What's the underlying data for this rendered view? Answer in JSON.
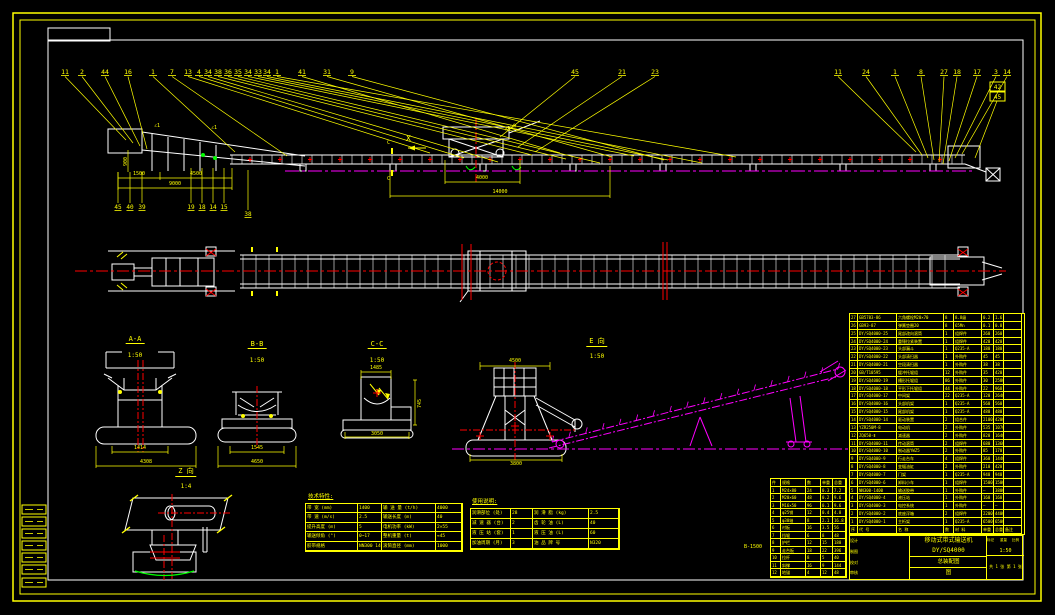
{
  "colors": {
    "accent": "#FFFF00",
    "line": "#FFFFFF",
    "centerline": "#FF0000",
    "phantom": "#FF00FF",
    "green": "#00FF00"
  },
  "views": {
    "sectionAA": {
      "label": "A-A",
      "scale": "1:50",
      "dim_inner": "1414",
      "dim_outer": "4308"
    },
    "sectionBB": {
      "label": "B-B",
      "scale": "1:50",
      "dim_inner": "1545",
      "dim_outer": "4650"
    },
    "sectionCC": {
      "label": "C-C",
      "scale": "1:50",
      "dim_top": "1485",
      "dim_right": "745",
      "dim_bottom": "3050"
    },
    "viewE": {
      "label": "E 向",
      "scale": "1:50",
      "dim_top": "4500",
      "dim_bottom": "3800"
    },
    "detailZ": {
      "label": "Z 向",
      "scale": "1:4"
    }
  },
  "side_view": {
    "view_marker": "X",
    "cut_mark": "C",
    "slope_mark": "∠1",
    "dims": {
      "v1": "900",
      "d1": "1500",
      "d2": "4500",
      "d3": "9000",
      "d4": "4000",
      "d5": "14000",
      "arm": "4000"
    }
  },
  "leaders": {
    "left": [
      "11",
      "2",
      "44",
      "16",
      "1",
      "7",
      "13",
      "4",
      "34",
      "38",
      "36",
      "35",
      "34",
      "33",
      "34",
      "1"
    ],
    "mid": [
      "41",
      "31",
      "9"
    ],
    "carr": [
      "45",
      "21",
      "23"
    ],
    "right": [
      "11",
      "24",
      "1",
      "8",
      "27",
      "18",
      "17",
      "3",
      "14"
    ],
    "stack": [
      "42",
      "45"
    ],
    "under": [
      "45",
      "40",
      "39",
      "19",
      "18",
      "14",
      "15",
      "38"
    ]
  },
  "tech_table": {
    "title": "技术特性:",
    "rows": [
      [
        "带 宽 (mm)",
        "1400",
        "输 送 量 (t/h)",
        "4000"
      ],
      [
        "带 速 (m/s)",
        "2.5",
        "输送长度 (m)",
        "40"
      ],
      [
        "提升高度 (m)",
        "5",
        "电机功率 (kW)",
        "2×55"
      ],
      [
        "输送倾角 (°)",
        "0~17",
        "整机重量 (t)",
        "≈45"
      ],
      [
        "胶带规格",
        "NN300 1400×6",
        "滚筒直径 (mm)",
        "1000"
      ]
    ]
  },
  "lub_table": {
    "title": "使用说明:",
    "rows": [
      [
        "润滑部位 (处)",
        "28",
        "润 滑 脂 (kg)",
        "2.5"
      ],
      [
        "减 速 器 (台)",
        "2",
        "齿 轮 油 (L)",
        "40"
      ],
      [
        "液 压 站 (套)",
        "1",
        "液 压 油 (L)",
        "60"
      ],
      [
        "加油周期 (月)",
        "3",
        "油 品 牌 号",
        "N320"
      ]
    ]
  },
  "left_table": {
    "note": "B-1500",
    "header": [
      "件",
      "规格",
      "数",
      "单重",
      "总重"
    ],
    "rows": [
      [
        "1",
        "M24×80",
        "24",
        "0.3",
        "7.2"
      ],
      [
        "2",
        "M20×60",
        "48",
        "0.2",
        "9.6"
      ],
      [
        "3",
        "M16×50",
        "96",
        "0.1",
        "9.6"
      ],
      [
        "4",
        "φ25销",
        "12",
        "0.4",
        "4.8"
      ],
      [
        "5",
        "φ30轴",
        "8",
        "2.1",
        "16.8"
      ],
      [
        "6",
        "衬板",
        "16",
        "3.5",
        "56"
      ],
      [
        "7",
        "挡辊",
        "6",
        "8",
        "48"
      ],
      [
        "8",
        "护栏",
        "12",
        "15",
        "180"
      ],
      [
        "9",
        "走台板",
        "18",
        "22",
        "396"
      ],
      [
        "10",
        "拉杆",
        "8",
        "5",
        "40"
      ],
      [
        "11",
        "斜撑",
        "16",
        "9",
        "144"
      ],
      [
        "12",
        "地锚",
        "4",
        "12",
        "48"
      ]
    ]
  },
  "bom": {
    "header": [
      "序",
      "代  号",
      "名  称",
      "数",
      "材 料",
      "单重",
      "总重",
      "备注"
    ],
    "rows": [
      [
        "27",
        "GB5783-86",
        "六角螺栓M20×70",
        "8",
        "8.8级",
        "0.2",
        "1.6",
        ""
      ],
      [
        "26",
        "GB93-87",
        "弹簧垫圈20",
        "8",
        "65Mn",
        "0.1",
        "0.8",
        ""
      ],
      [
        "25",
        "DY/SQ4000-25",
        "尾部改向滚筒",
        "1",
        "组焊件",
        "260",
        "260",
        ""
      ],
      [
        "24",
        "DY/SQ4000-24",
        "重锤拉紧装置",
        "1",
        "组焊件",
        "420",
        "420",
        ""
      ],
      [
        "23",
        "DY/SQ4000-23",
        "头部漏斗",
        "1",
        "Q235-A",
        "180",
        "180",
        ""
      ],
      [
        "22",
        "DY/SQ4000-22",
        "头部清扫器",
        "1",
        "外购件",
        "45",
        "45",
        ""
      ],
      [
        "21",
        "DY/SQ4000-21",
        "空段清扫器",
        "1",
        "外购件",
        "38",
        "38",
        ""
      ],
      [
        "20",
        "GB/T10595",
        "缓冲托辊组",
        "12",
        "外购件",
        "35",
        "420",
        ""
      ],
      [
        "19",
        "DY/SQ4000-19",
        "槽形托辊组",
        "86",
        "外购件",
        "30",
        "2580",
        ""
      ],
      [
        "18",
        "DY/SQ4000-18",
        "平形下托辊组",
        "44",
        "外购件",
        "22",
        "968",
        ""
      ],
      [
        "17",
        "DY/SQ4000-17",
        "中间架",
        "22",
        "Q235-A",
        "120",
        "2640",
        ""
      ],
      [
        "16",
        "DY/SQ4000-16",
        "头部机架",
        "1",
        "Q235-A",
        "560",
        "560",
        ""
      ],
      [
        "15",
        "DY/SQ4000-15",
        "尾部机架",
        "1",
        "Q235-A",
        "480",
        "480",
        ""
      ],
      [
        "14",
        "DY/SQ4000-14",
        "驱动装置",
        "2",
        "组合件",
        "2100",
        "4200",
        ""
      ],
      [
        "13",
        "YZR250M-8",
        "电动机",
        "2",
        "外购件",
        "535",
        "1070",
        ""
      ],
      [
        "12",
        "ZQ650-Ⅱ",
        "减速器",
        "2",
        "外购件",
        "820",
        "1640",
        ""
      ],
      [
        "11",
        "DY/SQ4000-11",
        "传动滚筒",
        "2",
        "组焊件",
        "680",
        "1360",
        ""
      ],
      [
        "10",
        "DY/SQ4000-10",
        "制动器YWZ5",
        "2",
        "外购件",
        "85",
        "170",
        ""
      ],
      [
        "9",
        "DY/SQ4000-9",
        "行走台车",
        "4",
        "组焊件",
        "360",
        "1440",
        ""
      ],
      [
        "8",
        "DY/SQ4000-8",
        "变幅油缸",
        "2",
        "外购件",
        "210",
        "420",
        ""
      ],
      [
        "7",
        "DY/SQ4000-7",
        "门架",
        "1",
        "Q235-A",
        "940",
        "940",
        ""
      ],
      [
        "6",
        "DY/SQ4000-6",
        "卸料小车",
        "1",
        "组焊件",
        "1500",
        "1500",
        ""
      ],
      [
        "5",
        "NN300-1400",
        "输送胶带",
        "1",
        "外购件",
        "—",
        "3800",
        ""
      ],
      [
        "4",
        "DY/SQ4000-4",
        "液压站",
        "1",
        "外购件",
        "160",
        "160",
        ""
      ],
      [
        "3",
        "DY/SQ4000-3",
        "电控系统",
        "1",
        "外购件",
        "—",
        "—",
        ""
      ],
      [
        "2",
        "DY/SQ4000-2",
        "底座浮箱",
        "2",
        "组焊件",
        "2200",
        "4400",
        ""
      ],
      [
        "1",
        "DY/SQ4000-1",
        "主桁架",
        "1",
        "Q235-A",
        "6500",
        "6500",
        ""
      ]
    ]
  },
  "titleblock": {
    "product": "移动式带式输送机",
    "model": "DY/SQ4000",
    "doc": "总装配图",
    "extra": "图",
    "mark_header": [
      "标记",
      "重量",
      "比例"
    ],
    "scale": "1:50",
    "sheet": "共 1 张 第 1 张",
    "sig_rows": [
      [
        "设计",
        "",
        ""
      ],
      [
        "制图",
        "",
        ""
      ],
      [
        "校对",
        "",
        ""
      ],
      [
        "审核",
        "",
        ""
      ]
    ]
  }
}
